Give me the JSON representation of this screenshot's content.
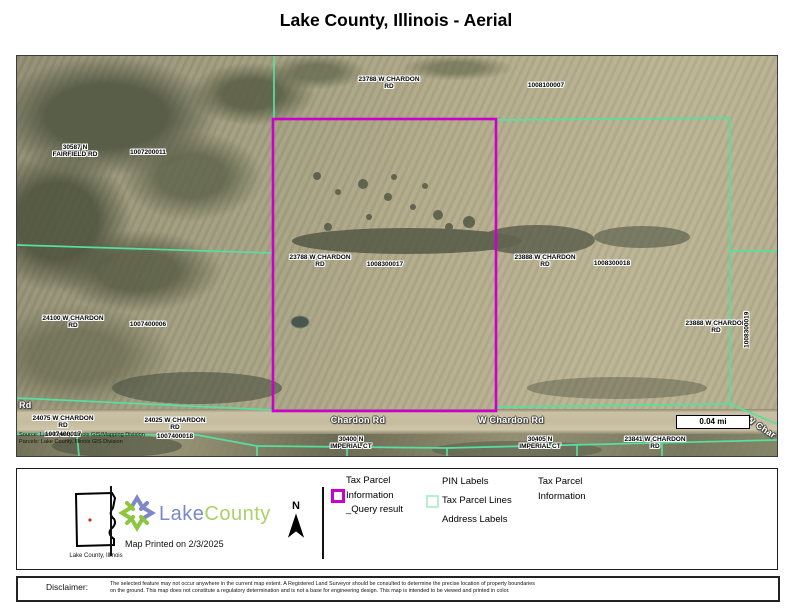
{
  "title": "Lake County, Illinois - Aerial",
  "colors": {
    "parcel_line": "#55e0a0",
    "query_highlight": "#cc00cc",
    "logo_lake_blue": "#7c88c8",
    "logo_county_green": "#a9d267"
  },
  "map": {
    "scale_label": "0.04 mi",
    "source_text": "Source: Lake County, Illinois GIS/Mapping Division\nParcels: Lake County, Illinois GIS Division",
    "labels": {
      "addr_23788_top": "23788  W CHARDON\nRD",
      "pin_1008100007": "1008100007",
      "addr_30587": "30587  N\nFAIRFIELD RD",
      "pin_1007200011": "1007200011",
      "addr_23788_mid": "23788  W CHARDON\nRD",
      "pin_1008300017": "1008300017",
      "addr_23888_mid": "23888  W CHARDON\nRD",
      "pin_1008300018": "1008300018",
      "addr_23888_right": "23888  W CHARDON\nRD",
      "pin_1008300019": "1008300019",
      "addr_24100": "24100  W CHARDON\nRD",
      "pin_1007400006": "1007400006",
      "road_rd": "Rd",
      "addr_24075": "24075  W CHARDON\nRD",
      "pin_1007400017": "1007400017",
      "addr_24025": "24025  W CHARDON\nRD",
      "pin_1007400018": "1007400018",
      "road_chardon": "Chardon Rd",
      "road_w_chardon": "W Chardon Rd",
      "addr_30400": "30400  N\nIMPERIAL CT",
      "addr_30405": "30405  N\nIMPERIAL CT",
      "addr_23841": "23841  W CHARDON\nRD",
      "road_w_char": "W Char"
    }
  },
  "legend": {
    "county_caption": "Lake County, Illinois",
    "logo_lake": "Lake",
    "logo_county": "County",
    "printed": "Map Printed on 2/3/2025",
    "north_label": "N",
    "items": {
      "query": "Tax Parcel\nInformation\n_Query result",
      "pin_labels": "PIN Labels",
      "parcel_lines": "Tax Parcel Lines",
      "address_labels": "Address Labels",
      "tax_parcel_info": "Tax Parcel\nInformation"
    }
  },
  "disclaimer": {
    "label": "Disclaimer:",
    "text": "The selected feature may not occur anywhere in the current map extent.  A Registered Land Surveyor should be consulted to determine the precise location of property boundaries\non the ground. This map does not constitute a regulatory determination and is not a base for engineering design.  This map is intended to be viewed and printed in color."
  }
}
